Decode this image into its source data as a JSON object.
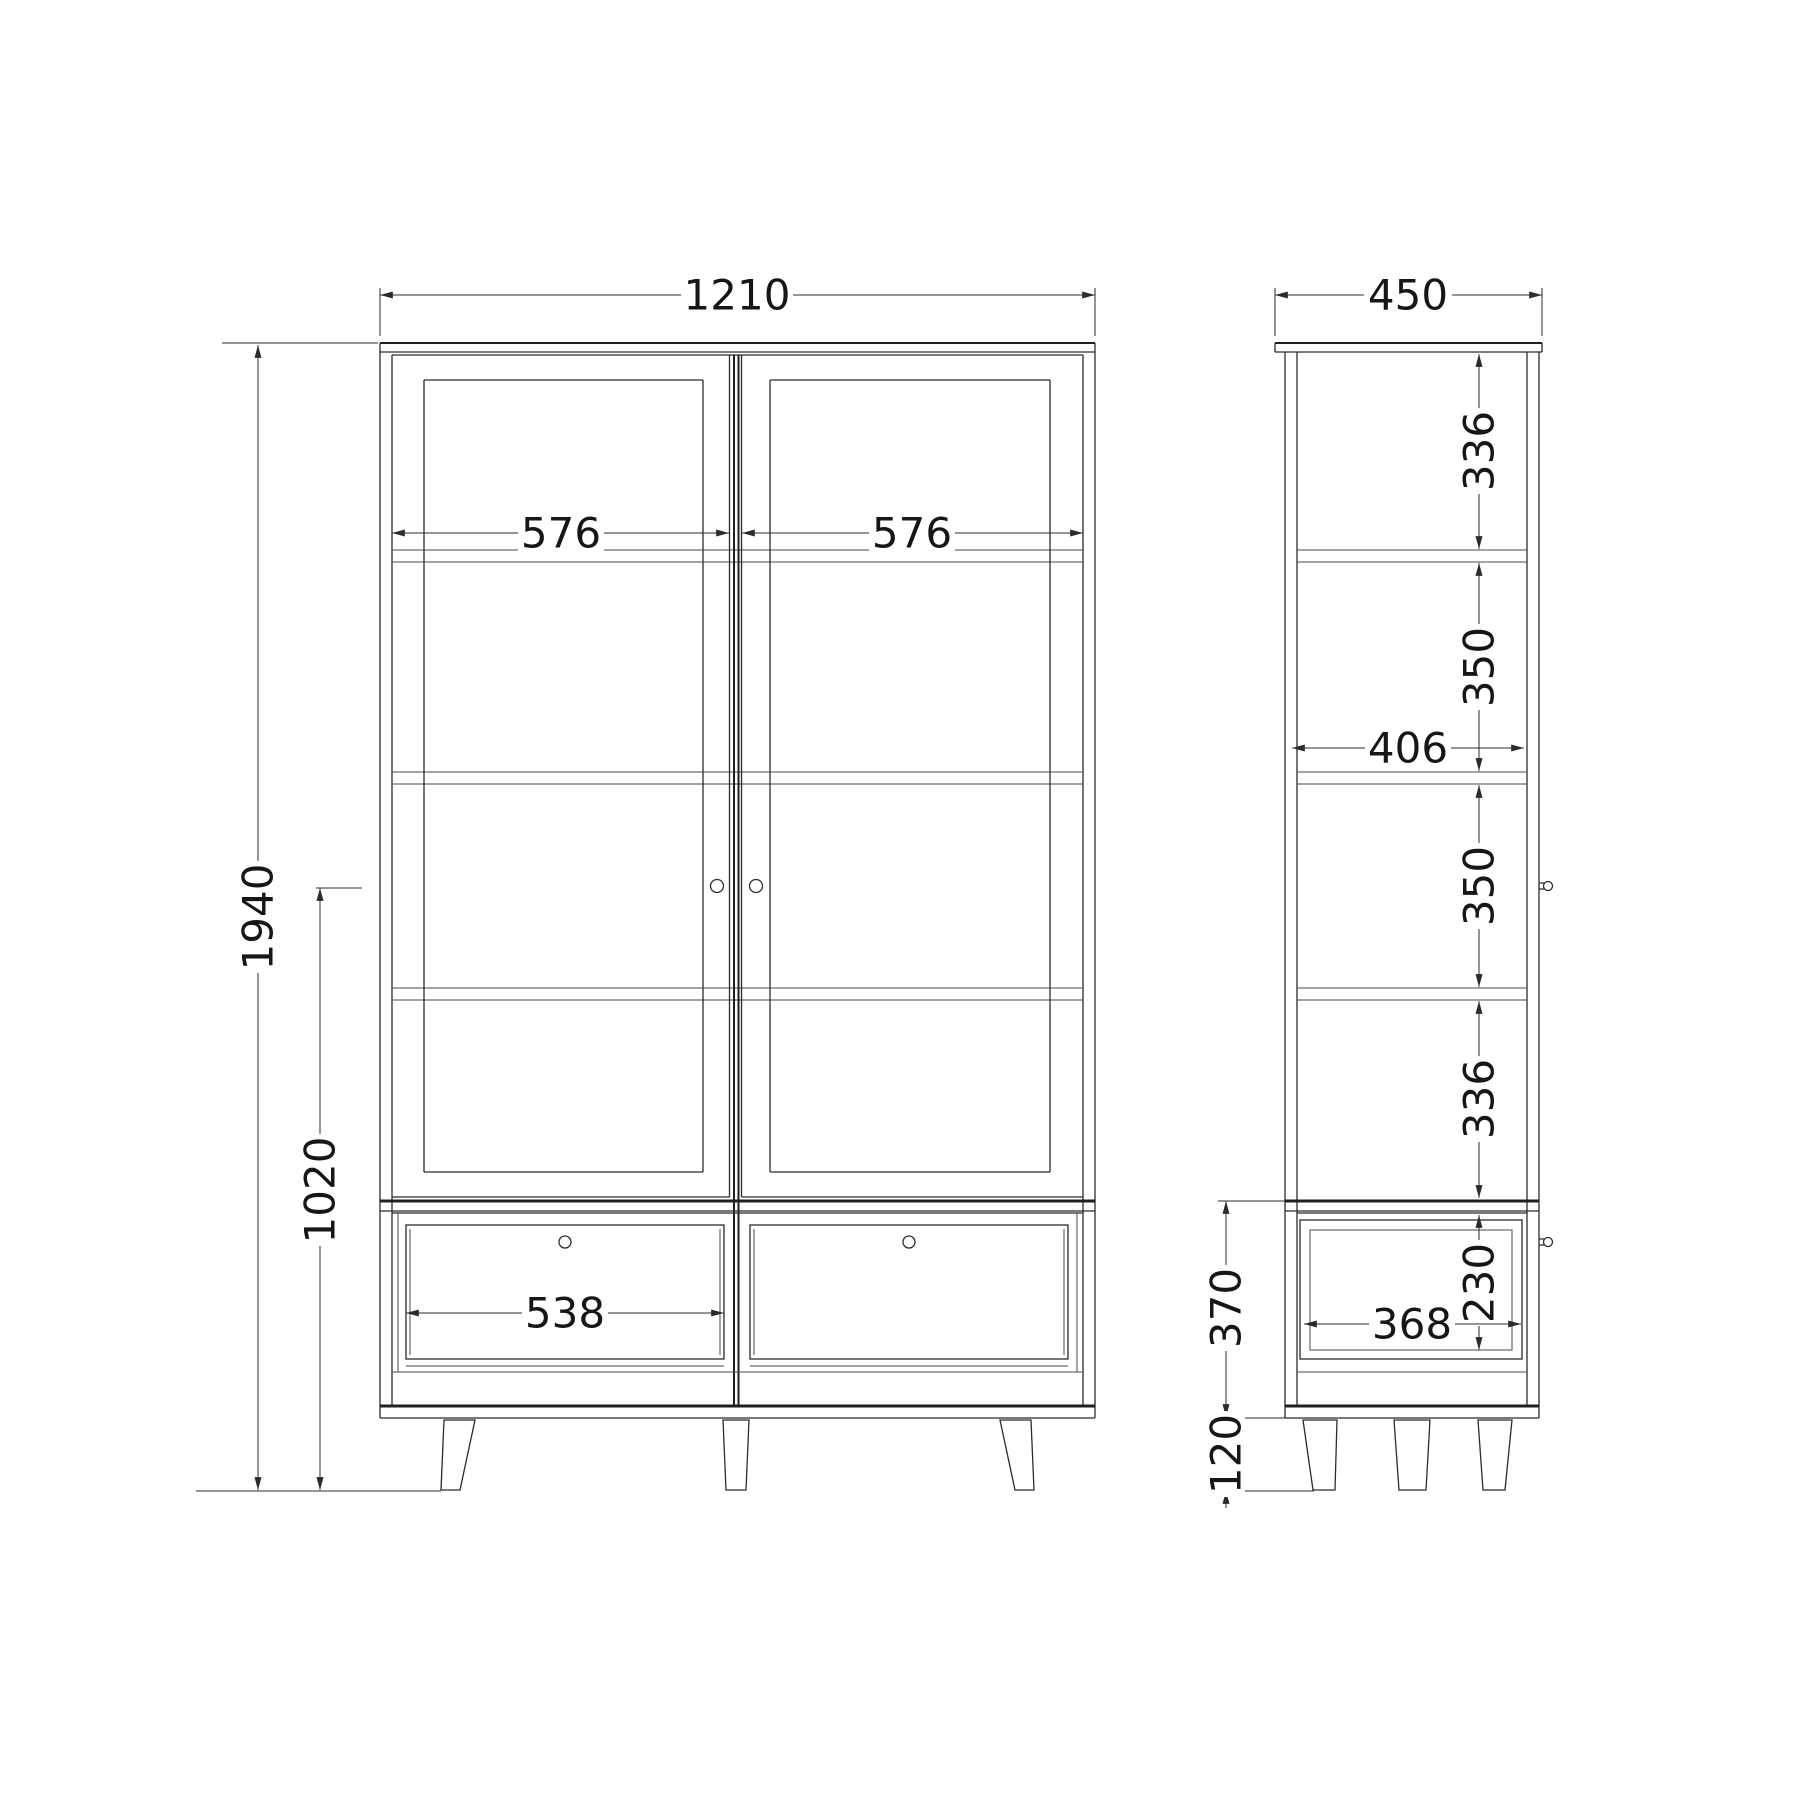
{
  "title": "Cabinet technical drawing, front and side elevations",
  "colors": {
    "line": "#2b2b2b",
    "background": "#ffffff",
    "text": "#161616"
  },
  "views": {
    "front": {
      "label": "front elevation",
      "dims": {
        "overall_width": "1210",
        "overall_height": "1940",
        "handle_height": "1020",
        "left_door_width": "576",
        "right_door_width": "576",
        "drawer_front_width": "538"
      }
    },
    "side": {
      "label": "side elevation",
      "dims": {
        "overall_depth": "450",
        "top_section": "336",
        "upper_middle_section": "350",
        "interior_depth": "406",
        "lower_middle_section": "350",
        "bottom_section": "336",
        "base_height": "370",
        "drawer_opening_height": "230",
        "drawer_depth": "368",
        "leg_height": "120"
      }
    }
  }
}
